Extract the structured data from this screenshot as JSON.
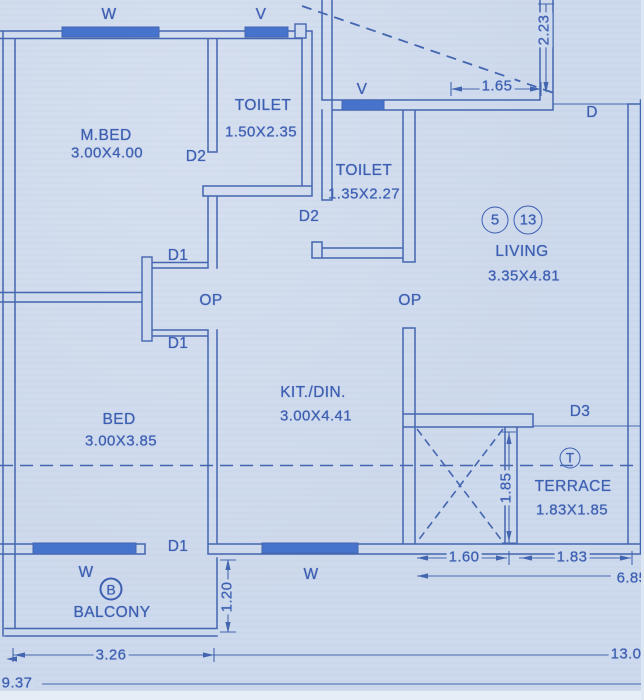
{
  "palette": {
    "bg": "#cdd9ec",
    "line": "#4466b0",
    "text": "#3d5fb2",
    "window": "#4673cb",
    "edge": "#e7edf6"
  },
  "rooms": {
    "mbed": {
      "name": "M.BED",
      "size": "3.00X4.00"
    },
    "toilet1": {
      "name": "TOILET",
      "size": "1.50X2.35"
    },
    "toilet2": {
      "name": "TOILET",
      "size": "1.35X2.27"
    },
    "living": {
      "name": "LIVING",
      "size": "3.35X4.81",
      "unit_a": "5",
      "unit_b": "13"
    },
    "kitchen": {
      "name": "KIT./DIN.",
      "size": "3.00X4.41"
    },
    "bed": {
      "name": "BED",
      "size": "3.00X3.85"
    },
    "terrace": {
      "name": "TERRACE",
      "size": "1.83X1.85",
      "marker": "T"
    },
    "balcony": {
      "name": "BALCONY",
      "marker": "B"
    }
  },
  "openings": {
    "door": "D",
    "door1": "D1",
    "door2": "D2",
    "door3": "D3",
    "wall_opening": "OP",
    "window": "W",
    "ventilator": "V"
  },
  "dimensions": {
    "wall_height_top_right": "2.23",
    "wall_width_top": "1.65",
    "duct_width": "1.60",
    "terrace_width": "1.83",
    "terrace_height": "1.85",
    "right_side_total": "6.85",
    "balcony_height": "1.20",
    "balcony_width": "3.26",
    "bottom_total": "13.0",
    "bottom_left_total": "9.37"
  }
}
